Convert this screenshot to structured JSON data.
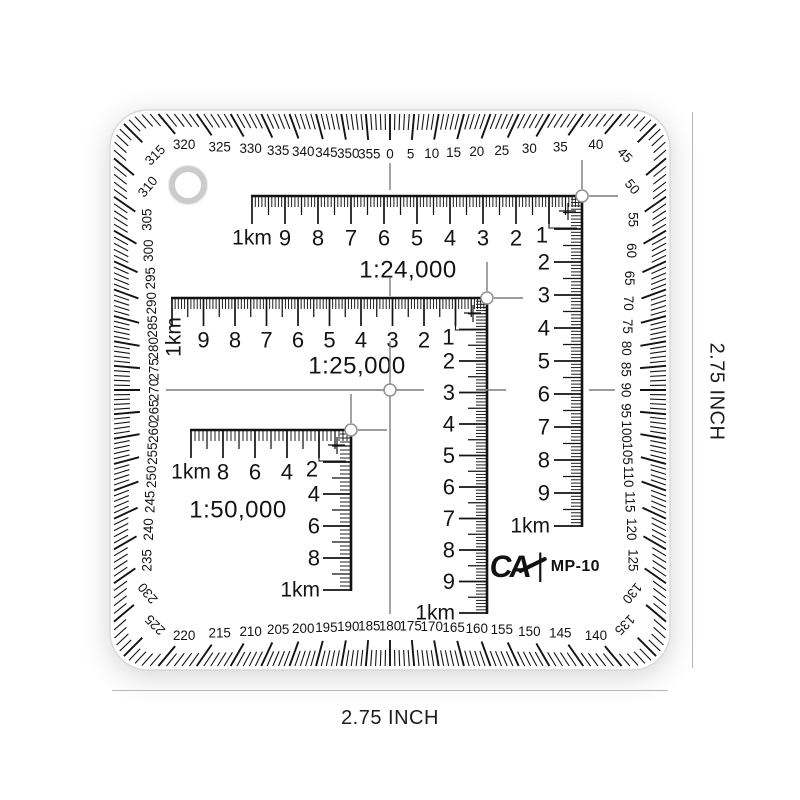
{
  "product": {
    "brand_logo": "CA",
    "logo_divider": "|",
    "model": "MP-10"
  },
  "annotations": {
    "bottom_dim": "2.75 INCH",
    "right_dim": "2.75 INCH"
  },
  "protractor": {
    "degree_tick_step": 1,
    "degree_label_step": 5,
    "degree_labels": [
      "0",
      "5",
      "10",
      "15",
      "20",
      "25",
      "30",
      "35",
      "40",
      "45",
      "50",
      "55",
      "60",
      "65",
      "70",
      "75",
      "80",
      "85",
      "90",
      "95",
      "100",
      "105",
      "110",
      "115",
      "120",
      "125",
      "130",
      "135",
      "140",
      "145",
      "150",
      "155",
      "160",
      "165",
      "170",
      "175",
      "180",
      "185",
      "190",
      "195",
      "200",
      "205",
      "210",
      "215",
      "220",
      "225",
      "230",
      "235",
      "240",
      "245",
      "250",
      "255",
      "260",
      "265",
      "270",
      "275",
      "280",
      "285",
      "290",
      "295",
      "300",
      "305",
      "310",
      "315",
      "320",
      "325",
      "330",
      "335",
      "340",
      "345",
      "350",
      "355"
    ]
  },
  "scales": [
    {
      "title": "1:24,000",
      "unit": "km",
      "h_labels": [
        "1km",
        "9",
        "8",
        "7",
        "6",
        "5",
        "4",
        "3",
        "2",
        "1"
      ],
      "v_labels": [
        "2",
        "3",
        "4",
        "5",
        "6",
        "7",
        "8",
        "9",
        "1km"
      ]
    },
    {
      "title": "1:25,000",
      "unit": "km",
      "h_labels": [
        "1km",
        "9",
        "8",
        "7",
        "6",
        "5",
        "4",
        "3",
        "2",
        "1"
      ],
      "v_labels": [
        "2",
        "3",
        "4",
        "5",
        "6",
        "7",
        "8",
        "9",
        "1km"
      ]
    },
    {
      "title": "1:50,000",
      "unit": "km",
      "h_labels": [
        "1km",
        "8",
        "6",
        "4",
        "2"
      ],
      "v_labels": [
        "4",
        "6",
        "8",
        "1km"
      ]
    }
  ],
  "colors": {
    "ink": "#131313",
    "guide": "#7c7c7c",
    "tool_outline": "#d8d8d8",
    "dim_line": "#b8b8b8",
    "text": "#1c1c1c"
  }
}
